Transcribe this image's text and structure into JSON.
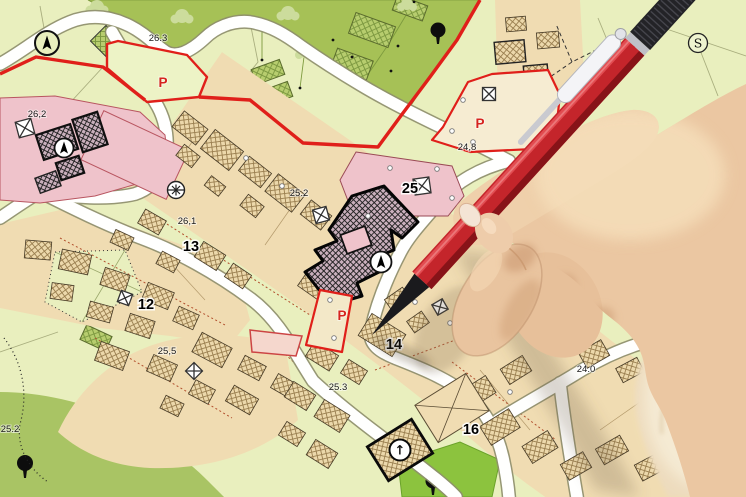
{
  "scene": {
    "description": "Cadastral city map (zoning plan) with a hand holding a red pen over it"
  },
  "map": {
    "elevation_labels": [
      {
        "text": "26.3"
      },
      {
        "text": "26,2"
      },
      {
        "text": "25.2"
      },
      {
        "text": "26,1"
      },
      {
        "text": "24,8"
      },
      {
        "text": "25,5"
      },
      {
        "text": "25.3"
      },
      {
        "text": "24.0"
      },
      {
        "text": "25.2"
      }
    ],
    "parcel_numbers": [
      {
        "text": "25"
      },
      {
        "text": "13"
      },
      {
        "text": "12"
      },
      {
        "text": "14"
      },
      {
        "text": "16"
      },
      {
        "text": "17"
      }
    ],
    "parking_markers": [
      {
        "text": "P"
      },
      {
        "text": "P"
      },
      {
        "text": "P"
      }
    ],
    "symbols": {
      "survey_marker": "S",
      "church_marker": "↑"
    },
    "colors": {
      "background": "#e9efbe",
      "forest_green": "#a6c156",
      "park_green": "#8cc33e",
      "urban_tan": "#f0dcb2",
      "parcel_pink": "#efc3cb",
      "boundary_red": "#e01f1a",
      "road_white": "#ffffff",
      "pen_red": "#c4252b",
      "skin": "#ebc7a2"
    }
  }
}
